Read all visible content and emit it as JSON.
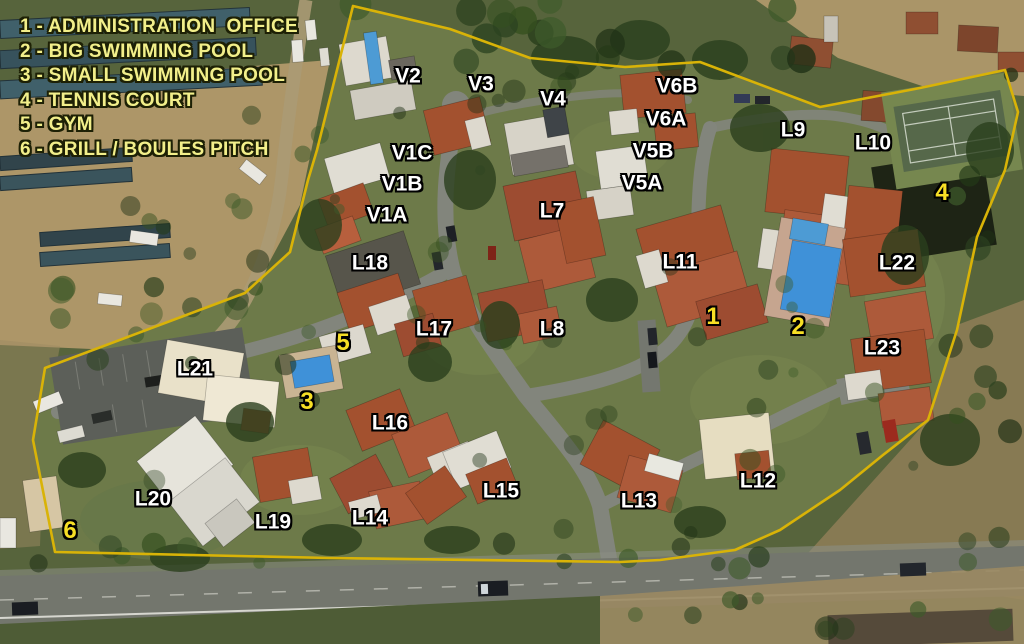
{
  "legend": {
    "separator": " - ",
    "items": [
      {
        "number": "1",
        "name": "ADMINISTRATION  OFFICE"
      },
      {
        "number": "2",
        "name": "BIG SWIMMING POOL"
      },
      {
        "number": "3",
        "name": "SMALL SWIMMING POOL"
      },
      {
        "number": "4",
        "name": "TENNIS COURT"
      },
      {
        "number": "5",
        "name": "GYM"
      },
      {
        "number": "6",
        "name": "GRILL / BOULES PITCH"
      }
    ]
  },
  "map": {
    "building_labels": [
      {
        "text": "V2",
        "x": 408,
        "y": 76
      },
      {
        "text": "V3",
        "x": 481,
        "y": 84
      },
      {
        "text": "V4",
        "x": 553,
        "y": 99
      },
      {
        "text": "V6B",
        "x": 677,
        "y": 86
      },
      {
        "text": "V6A",
        "x": 666,
        "y": 119
      },
      {
        "text": "V5B",
        "x": 653,
        "y": 151
      },
      {
        "text": "V5A",
        "x": 642,
        "y": 183
      },
      {
        "text": "V1C",
        "x": 412,
        "y": 153
      },
      {
        "text": "V1B",
        "x": 402,
        "y": 184
      },
      {
        "text": "V1A",
        "x": 387,
        "y": 215
      },
      {
        "text": "L7",
        "x": 552,
        "y": 211
      },
      {
        "text": "L8",
        "x": 552,
        "y": 329
      },
      {
        "text": "L9",
        "x": 793,
        "y": 130
      },
      {
        "text": "L10",
        "x": 873,
        "y": 143
      },
      {
        "text": "L11",
        "x": 680,
        "y": 262
      },
      {
        "text": "L22",
        "x": 897,
        "y": 263
      },
      {
        "text": "L23",
        "x": 882,
        "y": 348
      },
      {
        "text": "L18",
        "x": 370,
        "y": 263
      },
      {
        "text": "L17",
        "x": 434,
        "y": 329
      },
      {
        "text": "L16",
        "x": 390,
        "y": 423
      },
      {
        "text": "L21",
        "x": 195,
        "y": 369
      },
      {
        "text": "L20",
        "x": 153,
        "y": 499
      },
      {
        "text": "L19",
        "x": 273,
        "y": 522
      },
      {
        "text": "L14",
        "x": 370,
        "y": 518
      },
      {
        "text": "L15",
        "x": 501,
        "y": 491
      },
      {
        "text": "L13",
        "x": 639,
        "y": 501
      },
      {
        "text": "L12",
        "x": 758,
        "y": 481
      }
    ],
    "amenity_markers": [
      {
        "number": "1",
        "x": 713,
        "y": 317
      },
      {
        "number": "2",
        "x": 798,
        "y": 327
      },
      {
        "number": "3",
        "x": 307,
        "y": 402
      },
      {
        "number": "4",
        "x": 942,
        "y": 193
      },
      {
        "number": "5",
        "x": 343,
        "y": 343
      },
      {
        "number": "6",
        "x": 70,
        "y": 531
      }
    ],
    "colors": {
      "boundary": "#d9b307",
      "legend_text": "#f2ef8a",
      "building_label_text": "#ffffff",
      "amenity_marker_text": "#f7df25",
      "pool_water": "#3f91d8"
    }
  }
}
